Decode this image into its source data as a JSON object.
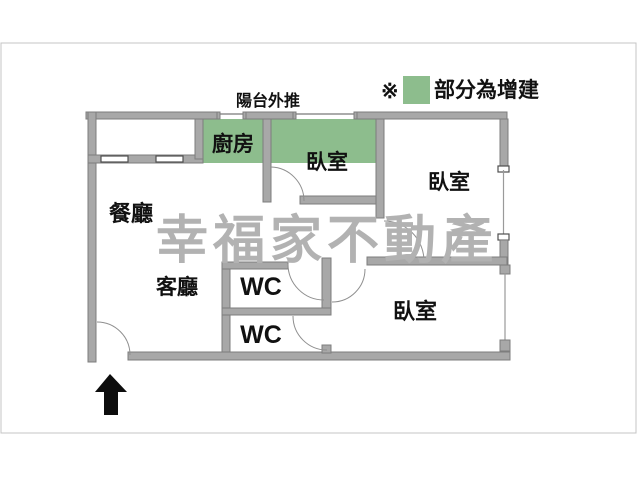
{
  "plan": {
    "balcony_note": "陽台外推",
    "legend": {
      "marker": "※",
      "label": "部分為增建"
    },
    "watermark": "幸福家不動產",
    "rooms": {
      "kitchen": "廚房",
      "bedroom_top_middle": "臥室",
      "bedroom_top_right": "臥室",
      "bedroom_bottom_right": "臥室",
      "dining_room": "餐廳",
      "living_room": "客廳",
      "wc_top": "WC",
      "wc_bottom": "WC"
    },
    "colors": {
      "addition_green": "#8dbd8d",
      "wall_gray": "#a8a8a8",
      "watermark_gray": "#b2b2b2"
    }
  }
}
